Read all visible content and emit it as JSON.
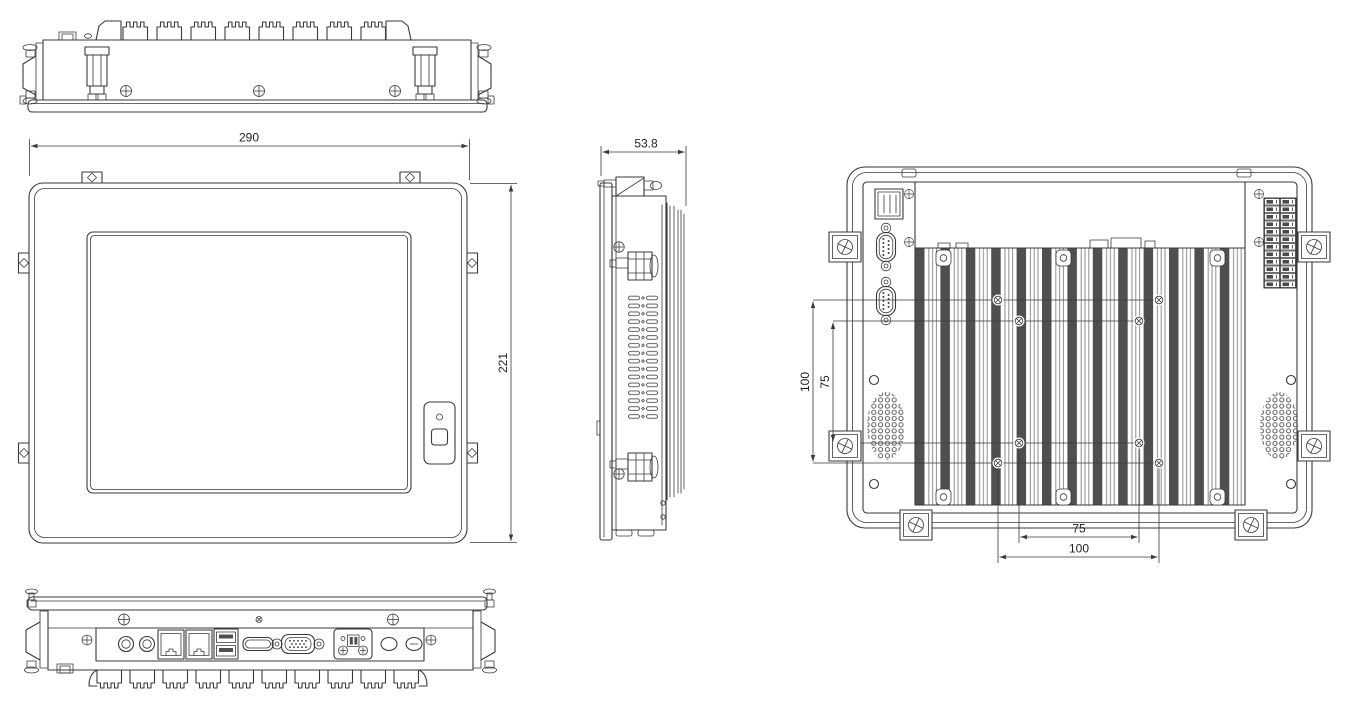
{
  "dimensions": {
    "front_width": "290",
    "front_height": "221",
    "side_depth": "53.8",
    "vesa_vertical_outer": "100",
    "vesa_vertical_inner": "75",
    "vesa_horizontal_inner": "75",
    "vesa_horizontal_outer": "100"
  },
  "colors": {
    "background": "#ffffff",
    "line": "#3a3a3a",
    "heatsink_fin": "#4f4f4f"
  }
}
